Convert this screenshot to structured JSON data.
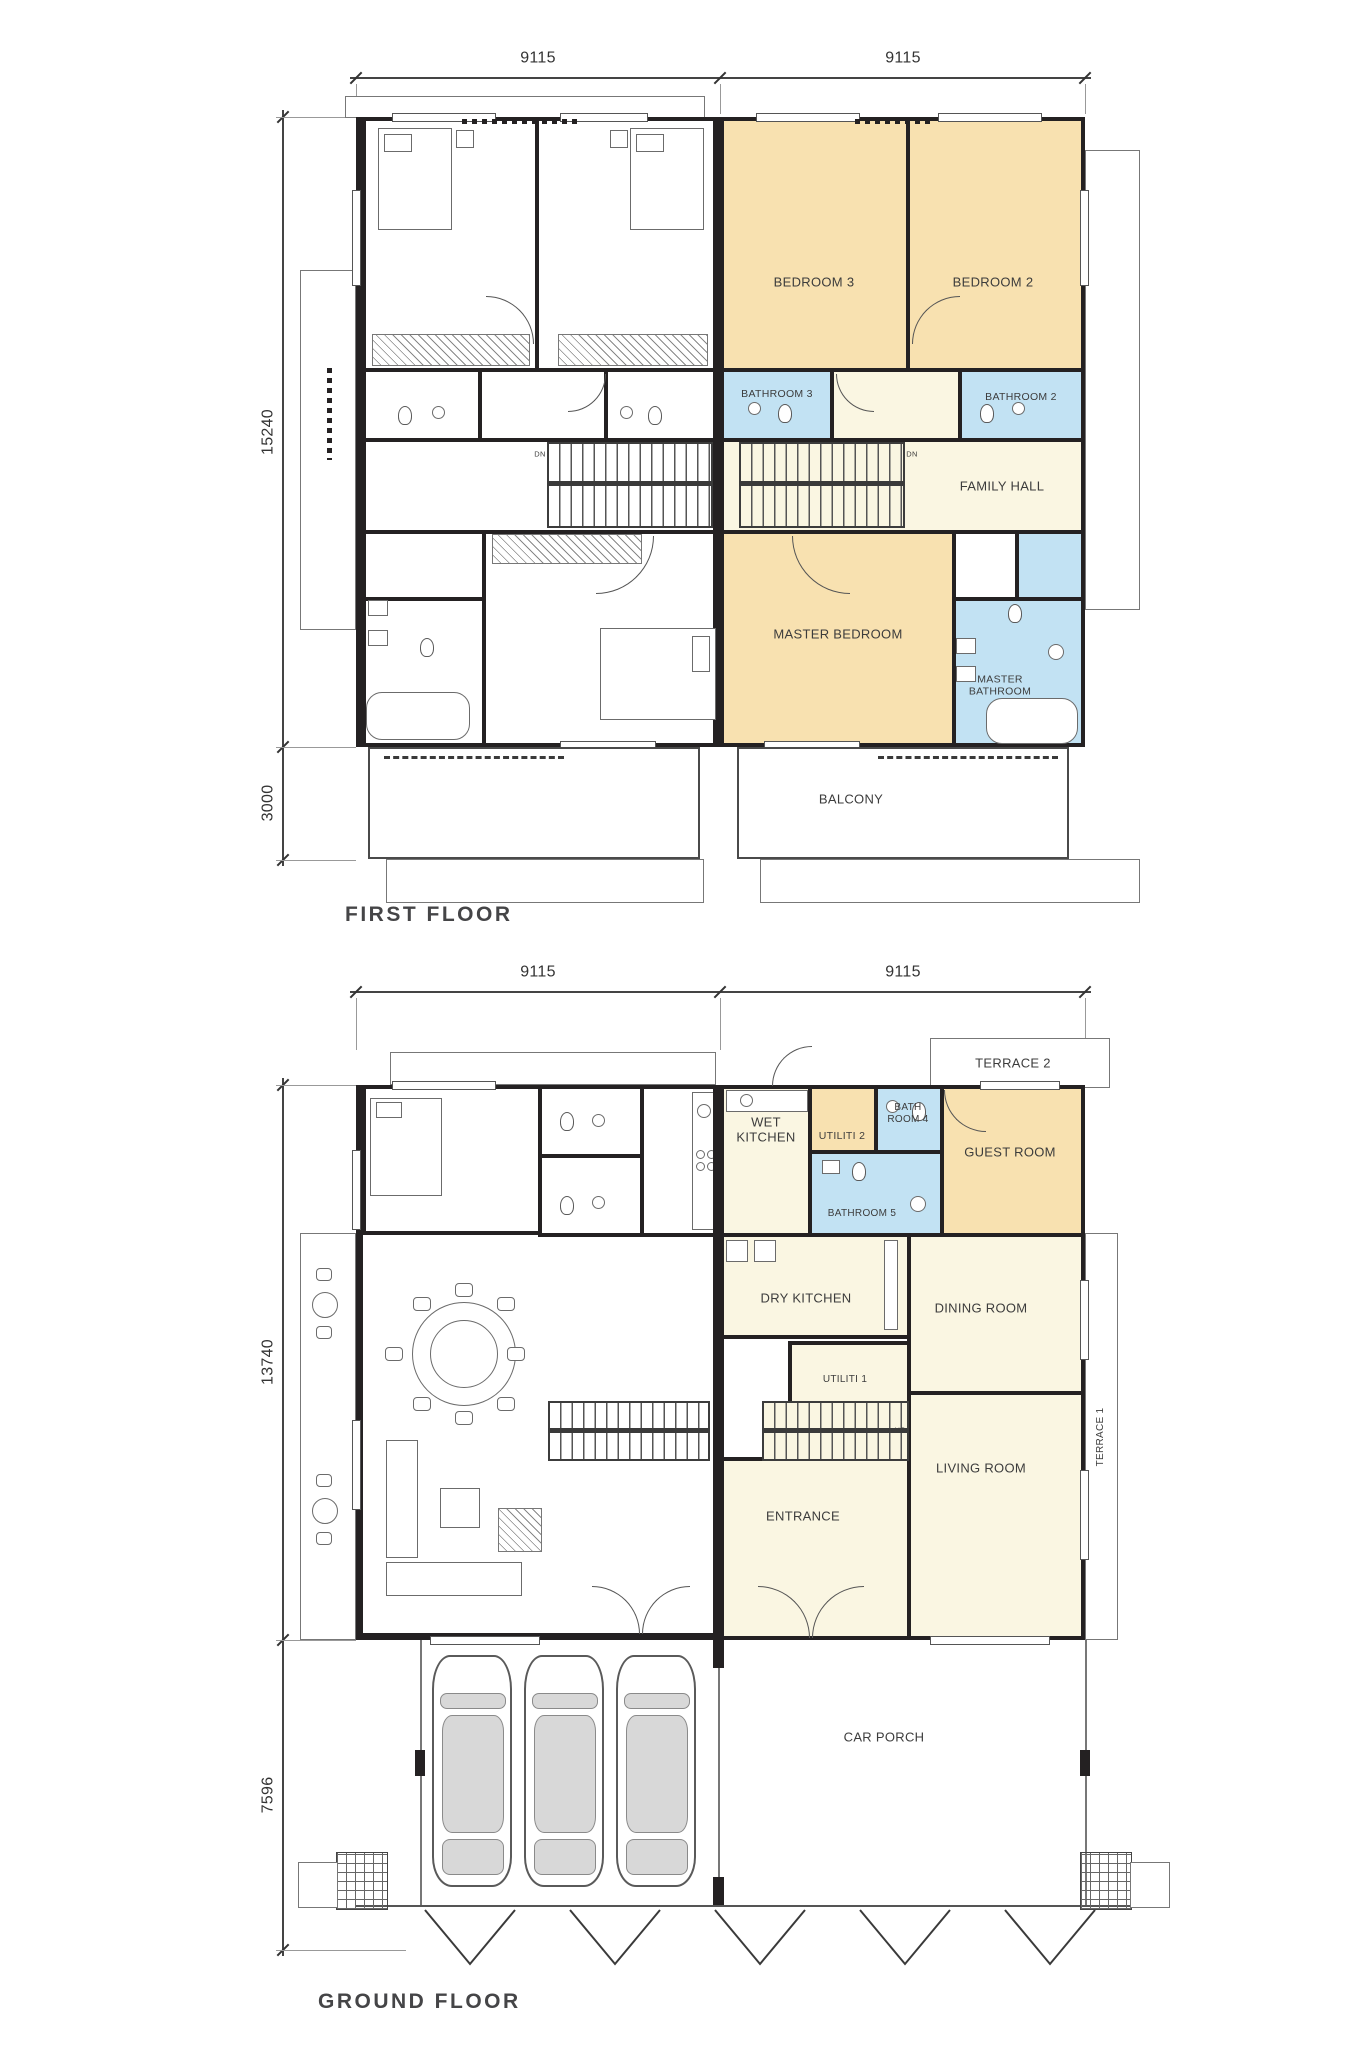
{
  "colors": {
    "wall": "#242122",
    "bedroom_fill": "#F8E1B0",
    "bathroom_fill": "#C2E2F3",
    "hall_fill": "#FAF6E2",
    "paper": "#FFFFFF"
  },
  "first_floor": {
    "title": "FIRST FLOOR",
    "dimensions": {
      "top_left": "9115",
      "top_right": "9115",
      "side_upper": "15240",
      "side_lower": "3000"
    },
    "rooms": {
      "bedroom3": "BEDROOM 3",
      "bedroom2": "BEDROOM 2",
      "bathroom3": "BATHROOM 3",
      "bathroom2": "BATHROOM 2",
      "family_hall": "FAMILY HALL",
      "master_bedroom": "MASTER BEDROOM",
      "master_bathroom": "MASTER BATHROOM",
      "balcony": "BALCONY"
    },
    "notes": {
      "stair_down_left": "DN",
      "stair_down_right": "DN"
    }
  },
  "ground_floor": {
    "title": "GROUND FLOOR",
    "dimensions": {
      "top_left": "9115",
      "top_right": "9115",
      "side_upper": "13740",
      "side_lower": "7596"
    },
    "rooms": {
      "terrace2": "TERRACE 2",
      "wet_kitchen": "WET KITCHEN",
      "utiliti2": "UTILITI 2",
      "bathroom4": "BATH ROOM 4",
      "guest_room": "GUEST ROOM",
      "bathroom5": "BATHROOM 5",
      "dry_kitchen": "DRY KITCHEN",
      "dining_room": "DINING ROOM",
      "utiliti1": "UTILITI 1",
      "living_room": "LIVING ROOM",
      "entrance": "ENTRANCE",
      "terrace1": "TERRACE 1",
      "car_porch": "CAR PORCH"
    },
    "notes": {
      "stair_up": "UP"
    }
  }
}
